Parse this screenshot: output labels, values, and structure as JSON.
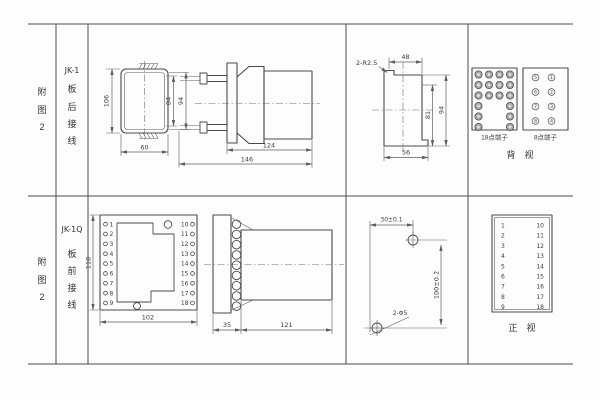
{
  "page": {
    "background": "#fdfdfd",
    "line_color": "#4a4a4a"
  },
  "row1": {
    "figure": [
      "附",
      "图",
      "2"
    ],
    "model": "JK-1",
    "wiring": [
      "板",
      "后",
      "接",
      "线"
    ],
    "front_view": {
      "height": "106",
      "inner_height": "84",
      "outer_height": "94",
      "width": "60"
    },
    "side_view": {
      "body_length": "124",
      "total_length": "146"
    },
    "cutout": {
      "corner_note": "2-R2.5",
      "top_width": "48",
      "inner_height": "81",
      "height": "94",
      "bottom_width": "56"
    },
    "rear_view": {
      "label": "背　视",
      "block18": {
        "label": "18点端子",
        "pattern": [
          [
            1,
            1,
            1,
            1
          ],
          [
            1,
            1,
            1,
            1
          ],
          [
            1,
            1,
            1,
            1
          ],
          [
            1,
            0,
            0,
            1
          ],
          [
            1,
            0,
            0,
            1
          ],
          [
            1,
            0,
            0,
            1
          ]
        ]
      },
      "block8": {
        "label": "8点端子",
        "left": [
          "5",
          "6",
          "7",
          "8"
        ],
        "right": [
          "1",
          "2",
          "3",
          "4"
        ]
      }
    }
  },
  "row2": {
    "figure": [
      "附",
      "图",
      "2"
    ],
    "model": "JK-1Q",
    "wiring": [
      "板",
      "前",
      "接",
      "线"
    ],
    "front_view": {
      "height": "118",
      "width": "102",
      "left_terminals": [
        "1",
        "2",
        "3",
        "4",
        "5",
        "6",
        "7",
        "8",
        "9"
      ],
      "right_terminals": [
        "10",
        "11",
        "12",
        "13",
        "14",
        "15",
        "16",
        "17",
        "18"
      ]
    },
    "side_view": {
      "plate_depth": "35",
      "body_length": "121",
      "terminal_count": 9
    },
    "drill_plan": {
      "hole_spacing_h": "30±0.1",
      "hole_spacing_v": "100±0.2",
      "hole_note": "2-Φ5"
    },
    "terminal_table": {
      "label": "正　视",
      "left": [
        "1",
        "2",
        "3",
        "4",
        "5",
        "6",
        "7",
        "8",
        "9"
      ],
      "right": [
        "10",
        "11",
        "12",
        "13",
        "14",
        "15",
        "16",
        "17",
        "18"
      ]
    }
  }
}
